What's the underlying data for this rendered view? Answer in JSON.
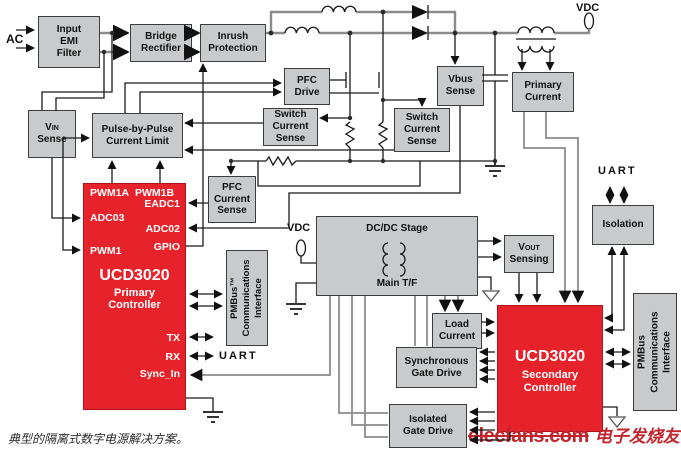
{
  "labels": {
    "ac": "AC",
    "vdc_top": "VDC",
    "vdc_mid": "VDC",
    "uart_primary": "UART",
    "uart_isolation": "UART"
  },
  "blocks": {
    "emi_filter": "Input\nEMI\nFilter",
    "bridge_rectifier": "Bridge\nRectifier",
    "inrush_protection": "Inrush\nProtection",
    "pfc_drive": "PFC\nDrive",
    "vin_sense": {
      "v": "V",
      "sub": "IN",
      "line2": "Sense"
    },
    "pulse_by_pulse": "Pulse-by-Pulse\nCurrent Limit",
    "switch_current_sense_left": "Switch\nCurrent\nSense",
    "switch_current_sense_right": "Switch\nCurrent\nSense",
    "vbus_sense": "Vbus\nSense",
    "primary_current": "Primary\nCurrent",
    "pfc_current_sense": "PFC\nCurrent\nSense",
    "pmbus_primary": "PMBus™\nCommunications\nInterface",
    "dcdc_stage_title": "DC/DC Stage",
    "dcdc_stage_sub": "Main T/F",
    "vout_sensing": {
      "v": "V",
      "sub": "OUT",
      "line2": "Sensing"
    },
    "isolation": "Isolation",
    "load_current": "Load\nCurrent",
    "sync_gate_drive": "Synchronous\nGate Drive",
    "isolated_gate_drive": "Isolated\nGate Drive",
    "pmbus_secondary": "PMBus\nCommunications\nInterface"
  },
  "primary_controller": {
    "title": "UCD3020",
    "line1": "Primary",
    "line2": "Controller",
    "pins": {
      "pwm1a": "PWM1A",
      "pwm1b": "PWM1B",
      "eadc1": "EADC1",
      "adc03": "ADC03",
      "adc02": "ADC02",
      "pwm1": "PWM1",
      "gpio": "GPIO",
      "tx": "TX",
      "rx": "RX",
      "sync_in": "Sync_In"
    }
  },
  "secondary_controller": {
    "title": "UCD3020",
    "line1": "Secondary",
    "line2": "Controller"
  },
  "caption": "典型的隔离式数字电源解决方案。",
  "watermark": {
    "site": "elecfans.com",
    "cn": "电子发烧友",
    "color": "#c0262d"
  },
  "colors": {
    "block_fill": "#c9cacb",
    "controller_fill": "#e6232b",
    "wire_signal": "#1a1a1a",
    "wire_power": "#8c8c8c"
  }
}
